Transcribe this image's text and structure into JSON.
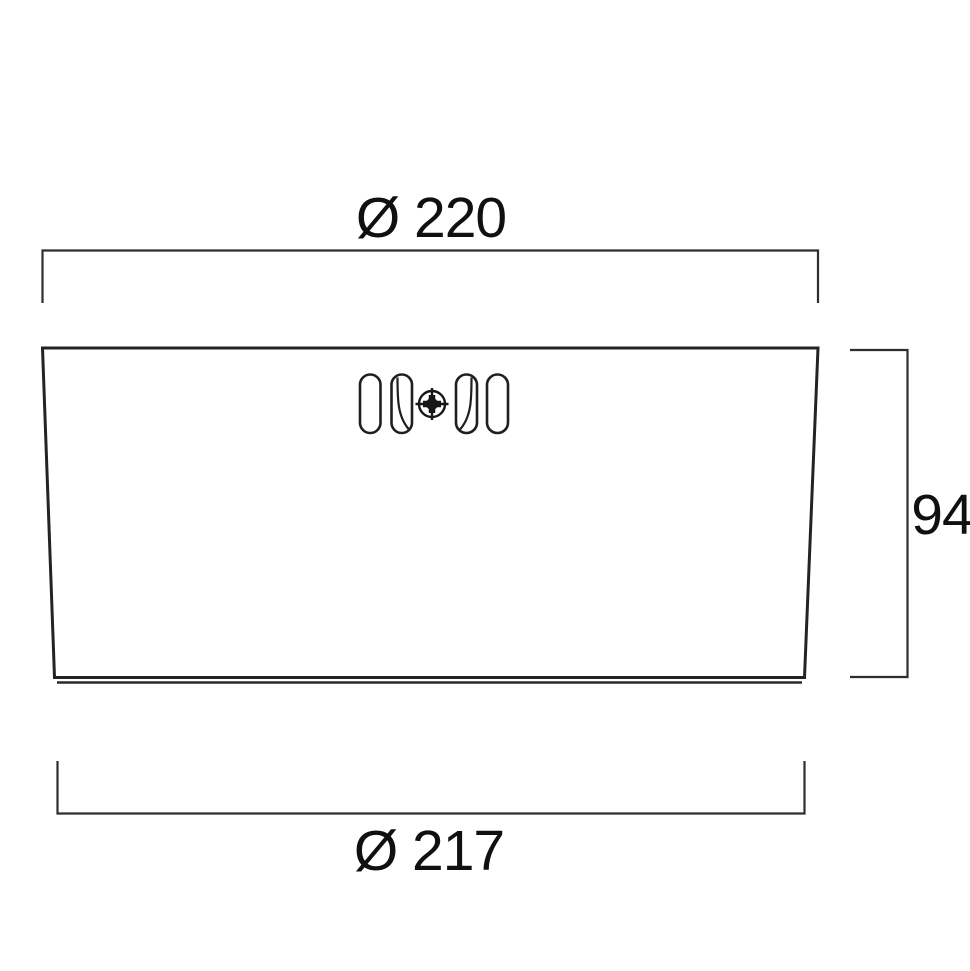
{
  "drawing": {
    "type": "technical-dimension-drawing",
    "view": "luminaire-housing-side-view",
    "labels": {
      "top_diameter": "Ø 220",
      "height": "94",
      "bottom_diameter": "Ø 217"
    },
    "values": {
      "top_diameter": 220,
      "height": 94,
      "bottom_diameter": 217
    },
    "icons": {
      "screw": "phillips-screw-head-icon",
      "slot": "ventilation-slot"
    },
    "colors": {
      "line": "#232323",
      "text": "#101010",
      "background": "#ffffff"
    }
  }
}
